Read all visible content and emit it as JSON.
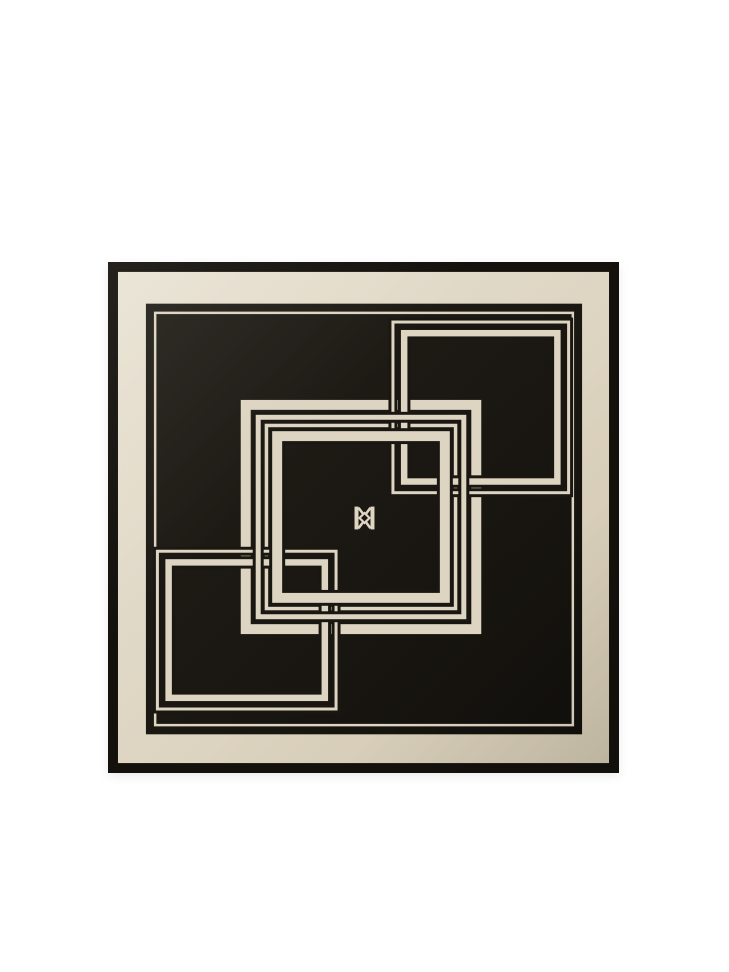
{
  "product": {
    "alt": "Folded black silk scarf with cream interlocking square line motif, framed cream border and double-K monogram at the center",
    "monogram_letters": "KK"
  },
  "colors": {
    "page_background": "#ffffff",
    "border_black": "#14110d",
    "scarf_black": "#1a1712",
    "scarf_black_soft": "#23201a",
    "scarf_black_deep": "#12100c",
    "cream": "#ddd4c1",
    "cream_light": "#e9e3d4",
    "cream_dark": "#cfc5ae"
  },
  "scarf": {
    "view": {
      "w": 512,
      "h": 515
    },
    "frame": {
      "outer": {
        "x": 0,
        "y": 0,
        "w": 512,
        "h": 515
      },
      "band": {
        "x": 10,
        "y": 10,
        "w": 492,
        "h": 495
      },
      "field": {
        "x": 38,
        "y": 42,
        "w": 437,
        "h": 434
      },
      "pinstripe": {
        "bbox": {
          "x": 46,
          "y": 50,
          "w": 421,
          "h": 418
        },
        "stroke": 2.5
      }
    },
    "center_square": {
      "bbox": {
        "x": 133,
        "y": 139,
        "w": 241,
        "h": 236
      },
      "lines": [
        {
          "inset": 0,
          "stroke": 10
        },
        {
          "inset": 15,
          "stroke": 5
        },
        {
          "inset": 24,
          "stroke": 3.5
        },
        {
          "inset": 31.5,
          "stroke": 10
        }
      ],
      "overdraw_line_indices": [
        1,
        3
      ]
    },
    "corner_squares": [
      {
        "name": "top-right-square",
        "bbox": {
          "x": 284,
          "y": 59,
          "w": 179,
          "h": 175
        },
        "lines": [
          {
            "inset": 0,
            "stroke": 3
          },
          {
            "inset": 9.5,
            "stroke": 6.5
          }
        ]
      },
      {
        "name": "bottom-left-square",
        "bbox": {
          "x": 48,
          "y": 290,
          "w": 182,
          "h": 162
        },
        "lines": [
          {
            "inset": 0,
            "stroke": 3
          },
          {
            "inset": 9.5,
            "stroke": 6.5
          }
        ]
      }
    ],
    "monogram": {
      "cx": 257,
      "cy": 258,
      "width": 20,
      "bar_height": 23,
      "bar_width": 4,
      "diamond_r": 5,
      "diag_stroke": 2.6,
      "diamond_stroke": 2.2
    }
  }
}
